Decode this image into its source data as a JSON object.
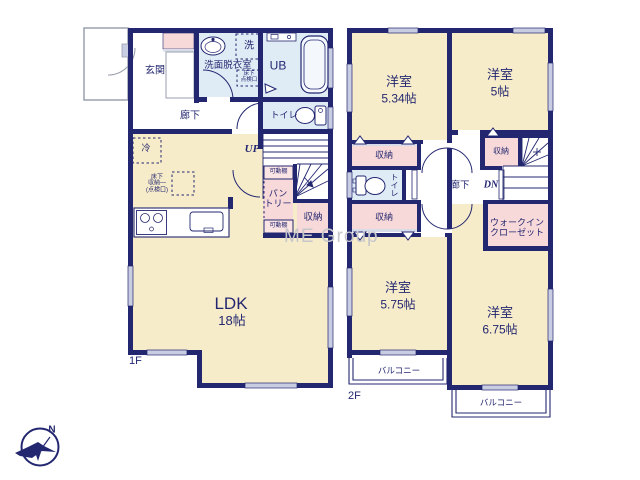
{
  "watermark": "ME Group",
  "compass": {
    "north": "N"
  },
  "colors": {
    "wall": "#232770",
    "room_cream": "#f7ecca",
    "closet_pink": "#f8d9d9",
    "wet_blue": "#dfecf6",
    "window_gray": "#c8cde2",
    "watermark_gray": "#c6c6cb"
  },
  "floor1": {
    "floor_label": "1F",
    "entrance": "玄関",
    "washroom": "洗面脱衣室",
    "laundry": "洗",
    "underfloor_access": "床下\n点検口",
    "unit_bath": "UB",
    "toilet": "トイレ",
    "hallway": "廊下",
    "stairs_up": "UP",
    "fridge": "冷",
    "underfloor_storage": "床下\n収納—\n(点検口)",
    "shelf_top": "可動棚",
    "pantry": "パン\nトリー",
    "shelf_bottom": "可動棚",
    "storage": "収納",
    "ldk_name": "LDK",
    "ldk_size": "18帖"
  },
  "floor2": {
    "floor_label": "2F",
    "room_nw_name": "洋室",
    "room_nw_size": "5.34帖",
    "room_ne_name": "洋室",
    "room_ne_size": "5帖",
    "room_sw_name": "洋室",
    "room_sw_size": "5.75帖",
    "room_se_name": "洋室",
    "room_se_size": "6.75帖",
    "closet_nw": "収納",
    "closet_sw": "収納",
    "closet_ne": "収納",
    "toilet": "トイレ",
    "hallway": "廊下",
    "stairs_down": "DN",
    "walk_in_closet": "ウォークイン\nクローゼット",
    "balcony_left": "バルコニー",
    "balcony_right": "バルコニー"
  }
}
